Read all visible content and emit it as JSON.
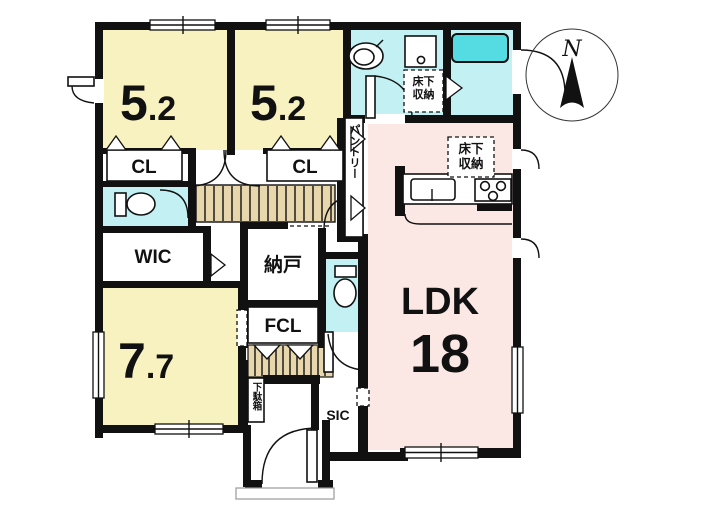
{
  "plan": {
    "bedroom1": {
      "size_main": "5",
      "size_frac": ".2"
    },
    "bedroom2": {
      "size_main": "5",
      "size_frac": ".2"
    },
    "bedroom3": {
      "size_main": "7",
      "size_frac": ".7"
    },
    "ldk": {
      "label": "LDK",
      "size": "18"
    },
    "closet1": {
      "label": "CL"
    },
    "closet2": {
      "label": "CL"
    },
    "wic": {
      "label": "WIC"
    },
    "nando": {
      "label": "納戸"
    },
    "fcl": {
      "label": "FCL"
    },
    "sic": {
      "label": "SIC"
    },
    "pantry": {
      "label": "パントリー"
    },
    "shoe_cabinet": {
      "label": "下駄箱"
    },
    "underfloor_storage_washroom": {
      "line1": "床下",
      "line2": "収納"
    },
    "underfloor_storage_ldk": {
      "line1": "床下",
      "line2": "収納"
    },
    "compass": {
      "north_label": "N"
    }
  },
  "colors": {
    "wall": "#111111",
    "room_yellow": "#F8F2C0",
    "room_pink": "#FBE8E5",
    "room_cyan": "#C3F0F2",
    "bathtub_cyan": "#55DCE2",
    "floor_wood": "#E8D7AC"
  }
}
